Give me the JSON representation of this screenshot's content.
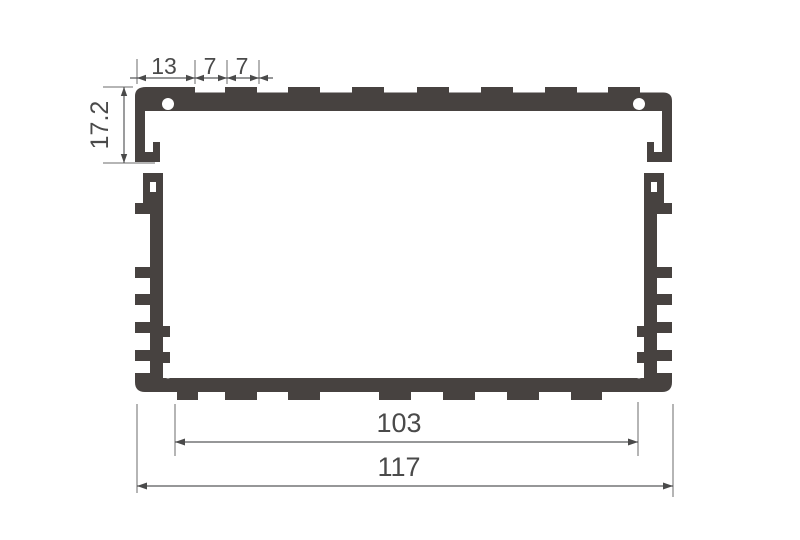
{
  "drawing": {
    "type": "technical-cross-section",
    "subject": "aluminum extrusion enclosure profile",
    "background": "#ffffff",
    "profile_color": "#474240",
    "line_color": "#58595b",
    "text_color": "#4a4a4a",
    "dimensions": {
      "top_left_margin": "13",
      "top_groove_a": "7",
      "top_groove_b": "7",
      "cover_height": "17.2",
      "inner_width": "103",
      "outer_width": "117"
    }
  }
}
